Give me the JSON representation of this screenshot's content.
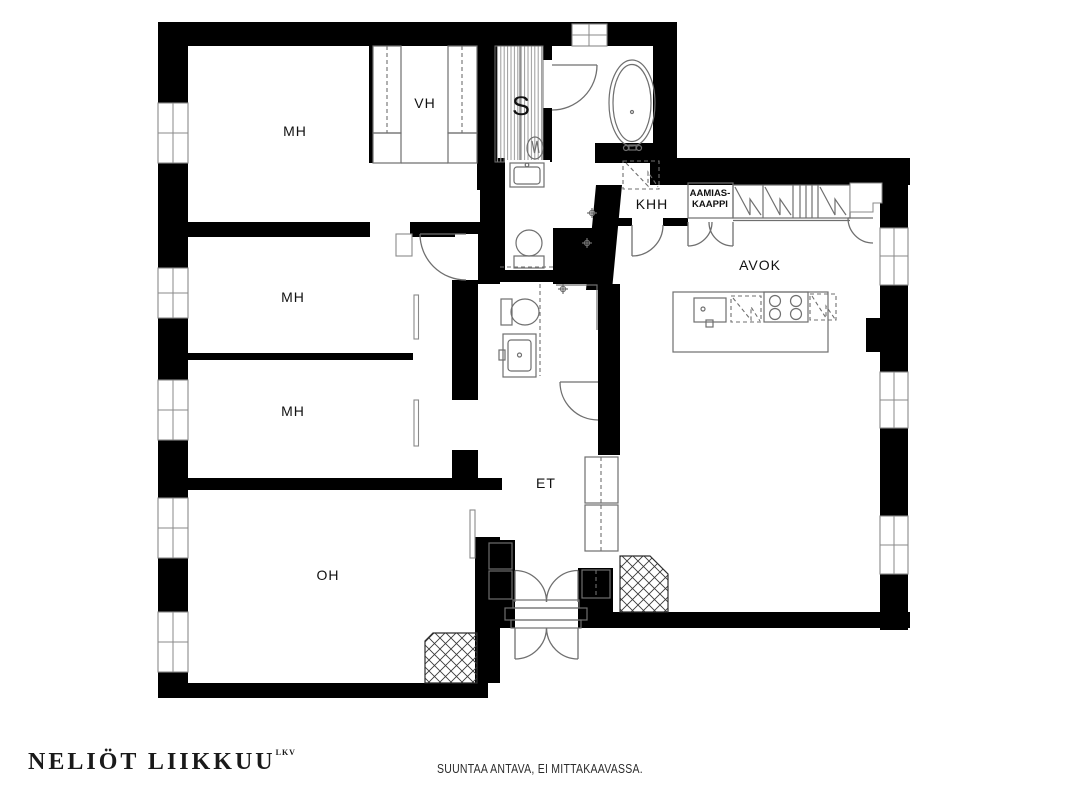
{
  "plan_title": "apartment-floor-plan",
  "colors": {
    "wall": "#000000",
    "fixture_line": "#6f6f6f",
    "hatch_line": "#2e2e2e",
    "label_text": "#111111",
    "background": "#ffffff"
  },
  "rooms": {
    "mh1": {
      "label": "MH"
    },
    "vh": {
      "label": "VH"
    },
    "sauna": {
      "label": "S"
    },
    "khh": {
      "label": "KHH"
    },
    "aamiaskaappi": {
      "line1": "AAMIAS-",
      "line2": "KAAPPI"
    },
    "avok": {
      "label": "AVOK"
    },
    "mh2": {
      "label": "MH"
    },
    "mh3": {
      "label": "MH"
    },
    "oh": {
      "label": "OH"
    },
    "et": {
      "label": "ET"
    }
  },
  "fixtures": [
    "bathtub",
    "sauna-stove",
    "washbasin",
    "toilet",
    "toilet-2",
    "shower",
    "washing-machine",
    "kitchen-island",
    "stove-4-burner",
    "kitchen-sink",
    "dishwasher-reservation",
    "wardrobes",
    "entrance-double-door",
    "fireplace-flue",
    "flue-hatched"
  ],
  "footer": {
    "brand": "NELIÖT LIIKKUU",
    "brand_suffix": "LKV",
    "disclaimer": "SUUNTAA ANTAVA, EI MITTAKAAVASSA."
  }
}
